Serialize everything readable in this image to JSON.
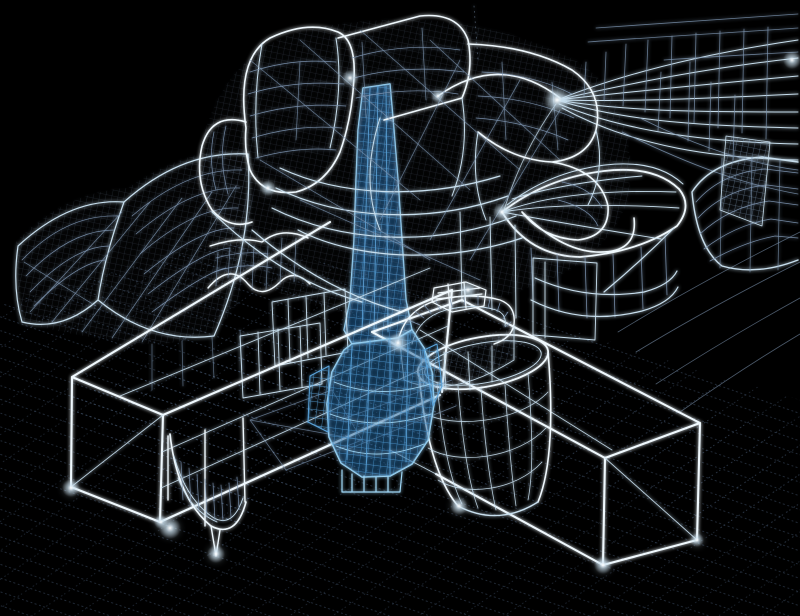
{
  "scene": {
    "kind": "3d-wireframe-cad-model",
    "subject": "sculptural-building-complex-massing",
    "view": "aerial-isometric",
    "background": "#000000",
    "highlight_note": "central-tower-highlighted-blue"
  },
  "colors": {
    "background": "#000000",
    "wire_bright": "#f0f9fe",
    "wire_main": "#c8dfee",
    "wire_dim": "#7e96b2",
    "wire_faint": "#4a5c76",
    "grid": "#3e5068",
    "blue_bright": "#9fd6f5",
    "blue_main": "#5aa4dc",
    "blue_deep": "#1d5c95",
    "glow_core": "#ffffff"
  },
  "components": [
    {
      "id": "ground-grid"
    },
    {
      "id": "ground-flow-lines"
    },
    {
      "id": "left-curved-sails"
    },
    {
      "id": "flow-ribbons-top-right"
    },
    {
      "id": "boat-shaped-gallery-right"
    },
    {
      "id": "right-edge-volume"
    },
    {
      "id": "mesh-panel-top-right"
    },
    {
      "id": "sculptural-cluster-top"
    },
    {
      "id": "left-rectangular-wing"
    },
    {
      "id": "right-rectangular-wing"
    },
    {
      "id": "cylindrical-rotunda"
    },
    {
      "id": "crenellated-crown"
    },
    {
      "id": "curved-annex-left"
    },
    {
      "id": "highlighted-tower-blue"
    },
    {
      "id": "glow-nodes"
    }
  ]
}
